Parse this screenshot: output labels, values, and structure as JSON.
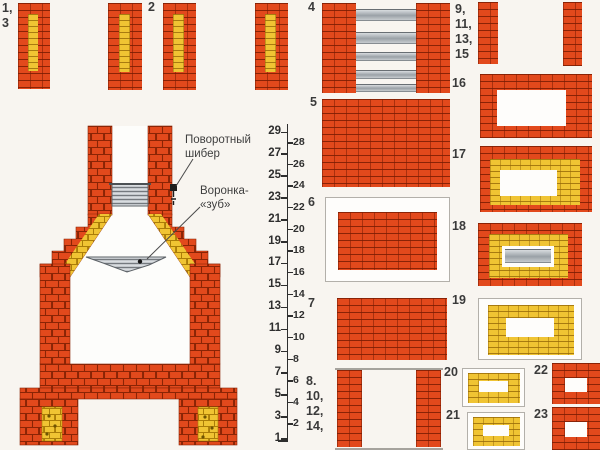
{
  "annotations": {
    "damper": {
      "line1": "Поворотный",
      "line2": "шибер"
    },
    "tooth": {
      "line1": "Воронка-",
      "line2": "«зуб»"
    }
  },
  "ruler": {
    "odd": [
      29,
      27,
      25,
      23,
      21,
      19,
      17,
      15,
      13,
      11,
      9,
      7,
      5,
      3,
      1
    ],
    "even": [
      28,
      26,
      24,
      22,
      20,
      18,
      16,
      14,
      12,
      10,
      8,
      6,
      4,
      2
    ]
  },
  "plates": [
    {
      "id": "1-3",
      "type": "core",
      "rect": [
        18,
        3,
        32,
        86
      ],
      "label": [
        "1,",
        "3"
      ],
      "label_pos": [
        2,
        1
      ]
    },
    {
      "id": "2a",
      "type": "core",
      "rect": [
        108,
        3,
        34,
        87
      ]
    },
    {
      "id": "2",
      "type": "core",
      "rect": [
        163,
        3,
        33,
        87
      ],
      "label": [
        "2"
      ],
      "label_pos": [
        148,
        0
      ]
    },
    {
      "id": "2b",
      "type": "core",
      "rect": [
        255,
        3,
        33,
        87
      ]
    },
    {
      "id": "4",
      "type": "grate",
      "rect": [
        322,
        3,
        128,
        90
      ],
      "label": [
        "4"
      ],
      "label_pos": [
        308,
        0
      ]
    },
    {
      "id": "9-11-13-15",
      "type": "twocols",
      "rect": [
        478,
        2,
        104,
        64
      ],
      "label": [
        "9,",
        "11,",
        "13,",
        "15"
      ],
      "label_pos": [
        455,
        2
      ]
    },
    {
      "id": "16",
      "type": "framered",
      "rect": [
        480,
        74,
        112,
        64
      ],
      "label": [
        "16"
      ],
      "label_pos": [
        452,
        76
      ]
    },
    {
      "id": "17",
      "type": "framery",
      "rect": [
        480,
        146,
        112,
        66
      ],
      "label": [
        "17"
      ],
      "label_pos": [
        452,
        147
      ]
    },
    {
      "id": "18",
      "type": "framerym",
      "rect": [
        478,
        223,
        104,
        63
      ],
      "label": [
        "18"
      ],
      "label_pos": [
        452,
        219
      ]
    },
    {
      "id": "5",
      "type": "solid",
      "rect": [
        322,
        99,
        128,
        88
      ],
      "label": [
        "5"
      ],
      "label_pos": [
        310,
        95
      ]
    },
    {
      "id": "6",
      "type": "insetsolid",
      "rect": [
        325,
        197,
        125,
        85
      ],
      "label": [
        "6"
      ],
      "label_pos": [
        308,
        195
      ]
    },
    {
      "id": "7",
      "type": "solid",
      "rect": [
        337,
        298,
        110,
        62
      ],
      "label": [
        "7"
      ],
      "label_pos": [
        308,
        296
      ]
    },
    {
      "id": "8-10-12-14",
      "type": "sidewalls",
      "rect": [
        335,
        368,
        108,
        82
      ],
      "label": [
        "8.",
        "10,",
        "12,",
        "14,"
      ],
      "label_pos": [
        306,
        374
      ]
    },
    {
      "id": "19",
      "type": "insetyellow",
      "rect": [
        478,
        298,
        104,
        62
      ],
      "label": [
        "19"
      ],
      "label_pos": [
        452,
        293
      ]
    },
    {
      "id": "20",
      "type": "insetyellow",
      "rect": [
        462,
        368,
        63,
        39
      ],
      "label": [
        "20"
      ],
      "label_pos": [
        444,
        365
      ]
    },
    {
      "id": "21",
      "type": "insetyellow",
      "rect": [
        467,
        412,
        58,
        38
      ],
      "label": [
        "21"
      ],
      "label_pos": [
        446,
        408
      ]
    },
    {
      "id": "22",
      "type": "frameredsm",
      "rect": [
        552,
        363,
        48,
        41
      ],
      "label": [
        "22"
      ],
      "label_pos": [
        534,
        363
      ]
    },
    {
      "id": "23",
      "type": "frameredsm",
      "rect": [
        552,
        407,
        48,
        43
      ],
      "label": [
        "23"
      ],
      "label_pos": [
        534,
        407
      ]
    }
  ],
  "colors": {
    "brick": "#e2491c",
    "brick_joint": "#8a2405",
    "firebrick_yellow": "#f0c433",
    "firebrick_joint": "#a97c0a",
    "metal": "#aeb4b9",
    "metal_light": "#d9dde0",
    "background": "#f8f5f0",
    "text": "#3a3a3a"
  }
}
